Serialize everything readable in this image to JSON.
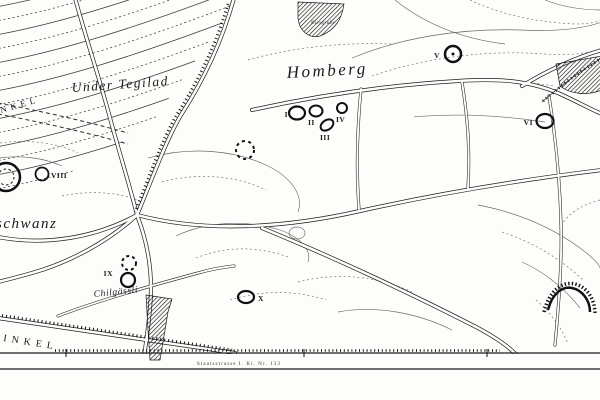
{
  "map": {
    "colors": {
      "paper": "#fdfdfb",
      "ink": "#1c1c1c"
    },
    "labels": {
      "region_top": "Under Tegilad",
      "region_main": "Homberg",
      "region_left_partial": "schwanz",
      "lane": "Chilgässli",
      "corner_top_partial": "NKEL",
      "corner_bottom_partial": "INKEL",
      "gravel_pit": "Kiesgrube",
      "road_bottom": "Staatsstrasse I. Kl. Nr. 133"
    },
    "markers": [
      {
        "numeral": "I",
        "style": "solid-ellipse"
      },
      {
        "numeral": "II",
        "style": "solid-ellipse"
      },
      {
        "numeral": "III",
        "style": "solid-ellipse-tilted"
      },
      {
        "numeral": "IV",
        "style": "solid-circle"
      },
      {
        "numeral": "V",
        "style": "solid-circle-with-center-dot"
      },
      {
        "numeral": "VI",
        "style": "solid-ellipse"
      },
      {
        "numeral": "VIII",
        "style": "solid-circle"
      },
      {
        "numeral": "IX",
        "style": "dashed-circle-above-solid-circle"
      },
      {
        "numeral": "X",
        "style": "solid-ellipse"
      }
    ]
  }
}
